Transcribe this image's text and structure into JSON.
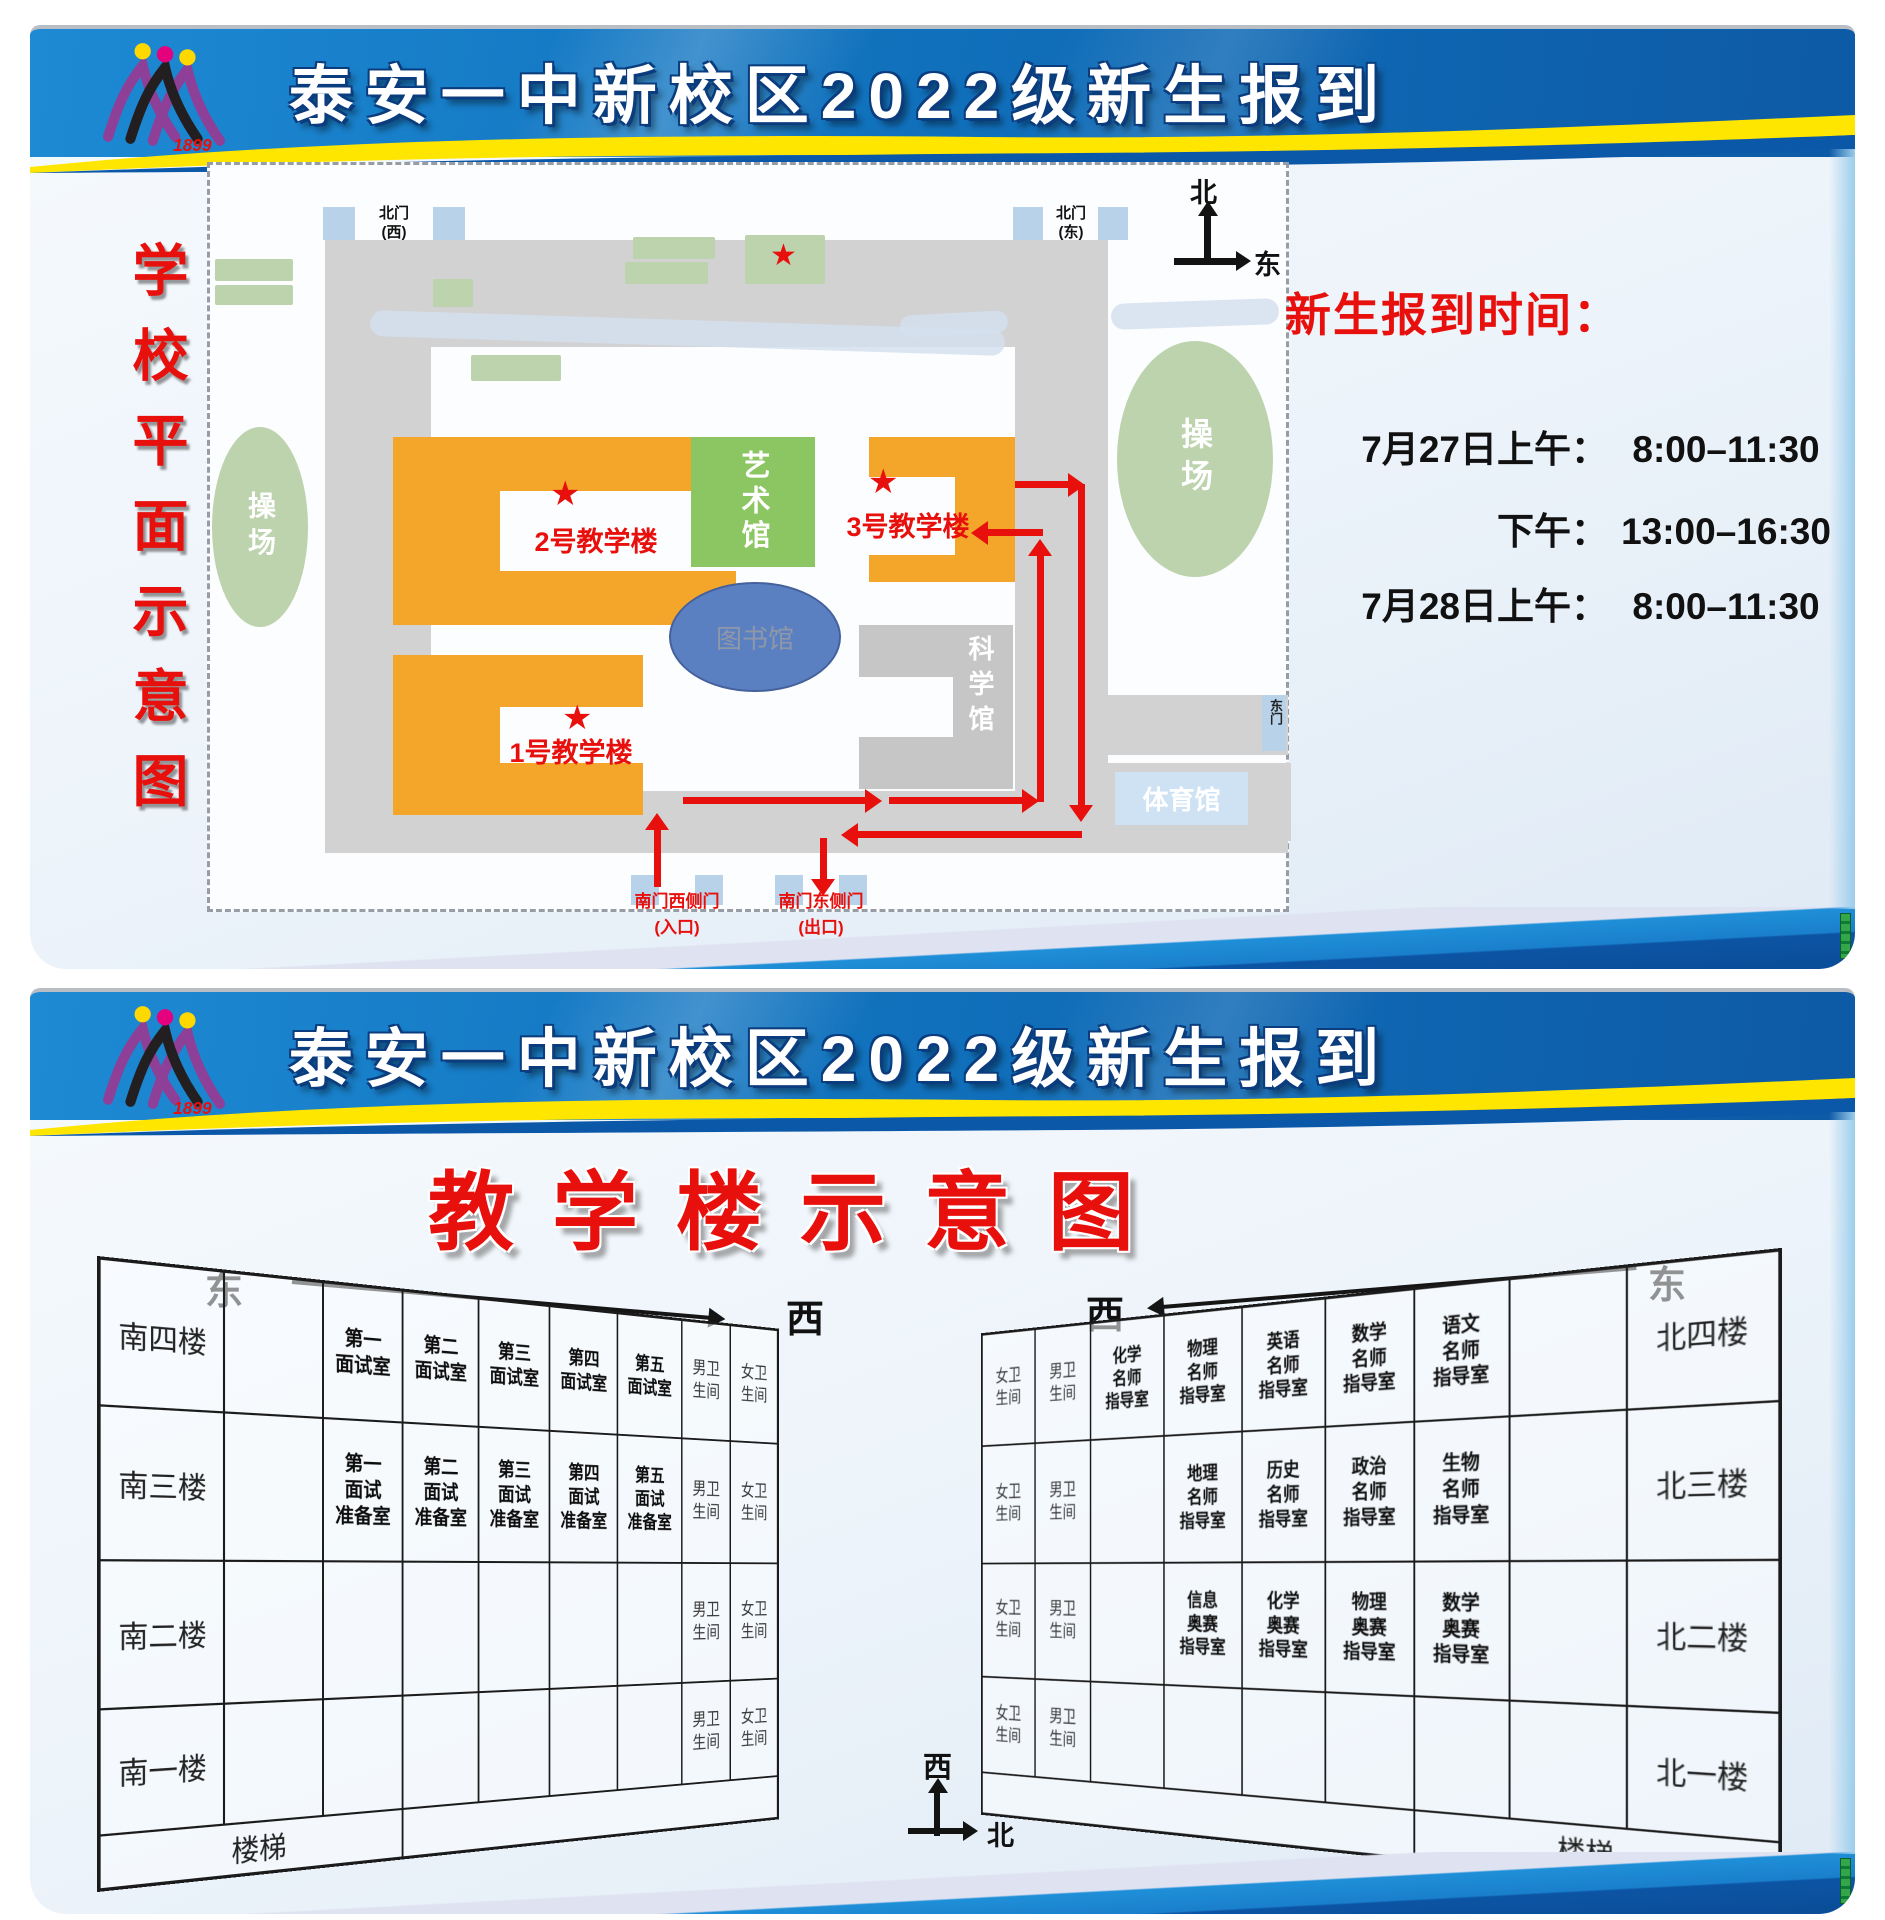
{
  "colors": {
    "accent_red": "#e8100c",
    "building_orange": "#f3a62a",
    "campus_green": "#8cc663",
    "light_green": "#bdd3ae",
    "library_blue": "#5b80c2",
    "road_gray": "#d2d2d2",
    "header_blue": "#1172bd",
    "band_yellow": "#ffe600"
  },
  "icons": {
    "star": "★"
  },
  "logo": {
    "year": "1899"
  },
  "board_top": {
    "title": "泰安一中新校区2022级新生报到",
    "side_title": "学校平面示意图",
    "map": {
      "labels": {
        "playground_left": "操场",
        "playground_right": "操场",
        "art_hall": "艺术馆",
        "library": "图书馆",
        "science_hall": "科学馆",
        "gym": "体育馆",
        "building1": "1号教学楼",
        "building2": "2号教学楼",
        "building3": "3号教学楼",
        "gate_nw": "北门\n(西)",
        "gate_ne": "北门\n(东)",
        "gate_e": "东门",
        "gate_sw": "南门西侧门\n(入口)",
        "gate_se": "南门东侧门\n(出口)"
      },
      "compass": {
        "north": "北",
        "east": "东"
      }
    },
    "schedule": {
      "title": "新生报到时间：",
      "rows": [
        {
          "label": "7月27日上午：",
          "time": "8:00–11:30"
        },
        {
          "label": "下午：",
          "time": "13:00–16:30"
        },
        {
          "label": "7月28日上午：",
          "time": "8:00–11:30"
        }
      ]
    }
  },
  "board_bottom": {
    "title": "泰安一中新校区2022级新生报到",
    "subtitle": "教学楼示意图",
    "dir": {
      "east_left": "东",
      "west_left": "西",
      "west_right": "西",
      "east_right": "东"
    },
    "compass": {
      "west": "西",
      "north": "北"
    },
    "left_table": {
      "rows": [
        [
          {
            "t": "南四楼",
            "c": "floor"
          },
          {
            "t": "",
            "c": "empty"
          },
          {
            "t": "第一\n面试室",
            "c": "room"
          },
          {
            "t": "第二\n面试室",
            "c": "room"
          },
          {
            "t": "第三\n面试室",
            "c": "room"
          },
          {
            "t": "第四\n面试室",
            "c": "room"
          },
          {
            "t": "第五\n面试室",
            "c": "room"
          },
          {
            "t": "男卫\n生间",
            "c": "wc"
          },
          {
            "t": "女卫\n生间",
            "c": "wc"
          }
        ],
        [
          {
            "t": "南三楼",
            "c": "floor"
          },
          {
            "t": "",
            "c": "empty"
          },
          {
            "t": "第一\n面试\n准备室",
            "c": "room"
          },
          {
            "t": "第二\n面试\n准备室",
            "c": "room"
          },
          {
            "t": "第三\n面试\n准备室",
            "c": "room"
          },
          {
            "t": "第四\n面试\n准备室",
            "c": "room"
          },
          {
            "t": "第五\n面试\n准备室",
            "c": "room"
          },
          {
            "t": "男卫\n生间",
            "c": "wc"
          },
          {
            "t": "女卫\n生间",
            "c": "wc"
          }
        ],
        [
          {
            "t": "南二楼",
            "c": "floor"
          },
          {
            "t": "",
            "c": "empty"
          },
          {
            "t": "",
            "c": "empty"
          },
          {
            "t": "",
            "c": "empty"
          },
          {
            "t": "",
            "c": "empty"
          },
          {
            "t": "",
            "c": "empty"
          },
          {
            "t": "",
            "c": "empty"
          },
          {
            "t": "男卫\n生间",
            "c": "wc"
          },
          {
            "t": "女卫\n生间",
            "c": "wc"
          }
        ],
        [
          {
            "t": "南一楼",
            "c": "floor"
          },
          {
            "t": "",
            "c": "empty"
          },
          {
            "t": "",
            "c": "empty"
          },
          {
            "t": "",
            "c": "empty"
          },
          {
            "t": "",
            "c": "empty"
          },
          {
            "t": "",
            "c": "empty"
          },
          {
            "t": "",
            "c": "empty"
          },
          {
            "t": "男卫\n生间",
            "c": "wc"
          },
          {
            "t": "女卫\n生间",
            "c": "wc"
          }
        ],
        [
          {
            "t": "楼梯",
            "c": "stairs",
            "s": 3
          },
          {
            "t": "",
            "c": "empty",
            "s": 6
          }
        ]
      ]
    },
    "right_table": {
      "rows": [
        [
          {
            "t": "女卫\n生间",
            "c": "wc"
          },
          {
            "t": "男卫\n生间",
            "c": "wc"
          },
          {
            "t": "化学\n名师\n指导室",
            "c": "room"
          },
          {
            "t": "物理\n名师\n指导室",
            "c": "room"
          },
          {
            "t": "英语\n名师\n指导室",
            "c": "room"
          },
          {
            "t": "数学\n名师\n指导室",
            "c": "room"
          },
          {
            "t": "语文\n名师\n指导室",
            "c": "room"
          },
          {
            "t": "",
            "c": "empty"
          },
          {
            "t": "北四楼",
            "c": "floor"
          }
        ],
        [
          {
            "t": "女卫\n生间",
            "c": "wc"
          },
          {
            "t": "男卫\n生间",
            "c": "wc"
          },
          {
            "t": "",
            "c": "empty"
          },
          {
            "t": "地理\n名师\n指导室",
            "c": "room"
          },
          {
            "t": "历史\n名师\n指导室",
            "c": "room"
          },
          {
            "t": "政治\n名师\n指导室",
            "c": "room"
          },
          {
            "t": "生物\n名师\n指导室",
            "c": "room"
          },
          {
            "t": "",
            "c": "empty"
          },
          {
            "t": "北三楼",
            "c": "floor"
          }
        ],
        [
          {
            "t": "女卫\n生间",
            "c": "wc"
          },
          {
            "t": "男卫\n生间",
            "c": "wc"
          },
          {
            "t": "",
            "c": "empty"
          },
          {
            "t": "信息\n奥赛\n指导室",
            "c": "room"
          },
          {
            "t": "化学\n奥赛\n指导室",
            "c": "room"
          },
          {
            "t": "物理\n奥赛\n指导室",
            "c": "room"
          },
          {
            "t": "数学\n奥赛\n指导室",
            "c": "room"
          },
          {
            "t": "",
            "c": "empty"
          },
          {
            "t": "北二楼",
            "c": "floor"
          }
        ],
        [
          {
            "t": "女卫\n生间",
            "c": "wc"
          },
          {
            "t": "男卫\n生间",
            "c": "wc"
          },
          {
            "t": "",
            "c": "empty"
          },
          {
            "t": "",
            "c": "empty"
          },
          {
            "t": "",
            "c": "empty"
          },
          {
            "t": "",
            "c": "empty"
          },
          {
            "t": "",
            "c": "empty"
          },
          {
            "t": "",
            "c": "empty"
          },
          {
            "t": "北一楼",
            "c": "floor"
          }
        ],
        [
          {
            "t": "",
            "c": "empty",
            "s": 6
          },
          {
            "t": "楼梯",
            "c": "stairs",
            "s": 3
          }
        ]
      ]
    }
  }
}
